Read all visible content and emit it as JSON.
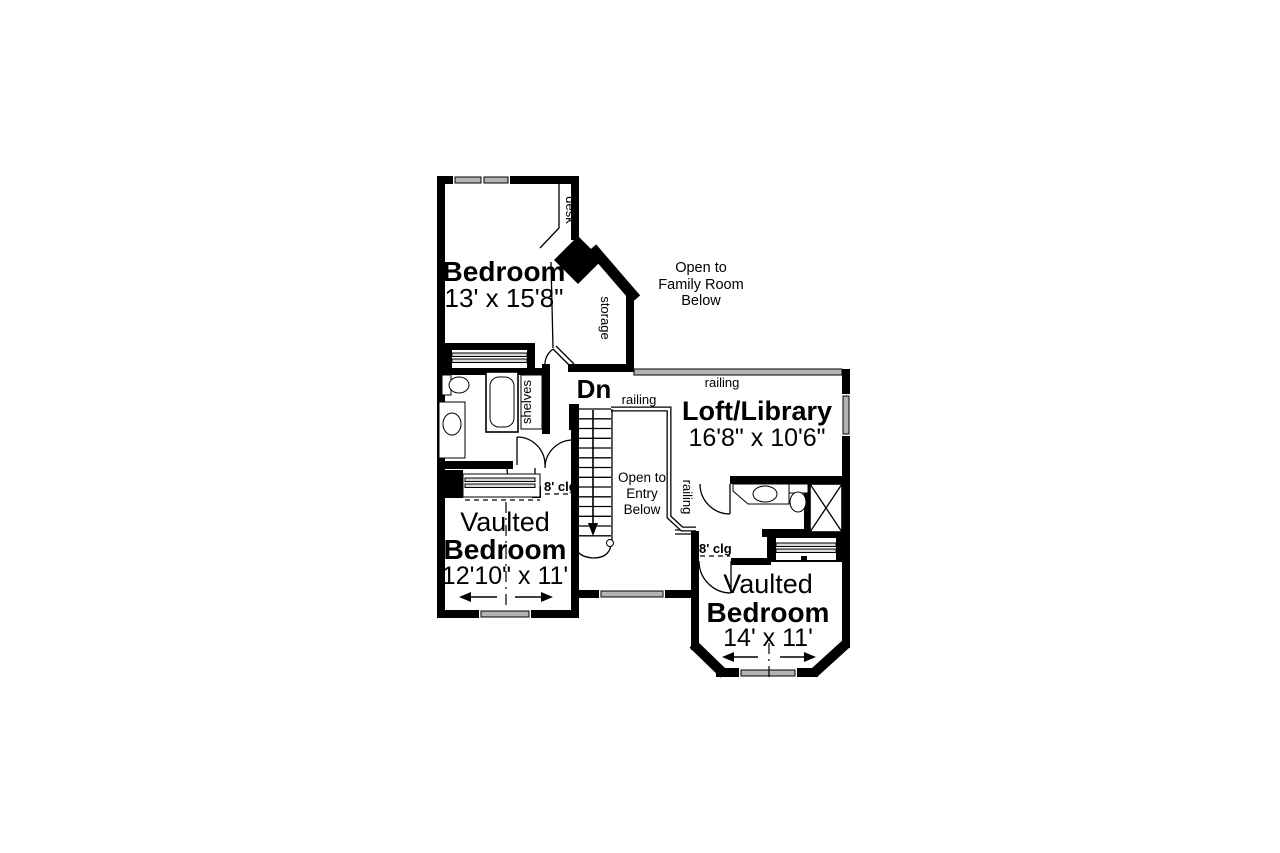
{
  "plan": {
    "bedroom1": {
      "name": "Bedroom",
      "dims": "13' x 15'8\""
    },
    "bedroom2": {
      "line1": "Vaulted",
      "line2": "Bedroom",
      "dims": "12'10\" x 11'"
    },
    "bedroom3": {
      "line1": "Vaulted",
      "line2": "Bedroom",
      "dims": "14' x 11'"
    },
    "loft": {
      "name": "Loft/Library",
      "dims": "16'8\" x 10'6\""
    },
    "open_family": [
      "Open to",
      "Family Room",
      "Below"
    ],
    "open_entry": [
      "Open to",
      "Entry",
      "Below"
    ],
    "stairs_label": "Dn",
    "railing_labels": [
      "railing",
      "railing",
      "railing"
    ],
    "ceiling_left": "8' clg",
    "ceiling_right": "8' clg",
    "desk_label": "desk",
    "storage_label": "storage",
    "shelves_label": "shelves"
  },
  "colors": {
    "wall": "#000000",
    "window": "#b3b3b3",
    "background": "#ffffff"
  }
}
